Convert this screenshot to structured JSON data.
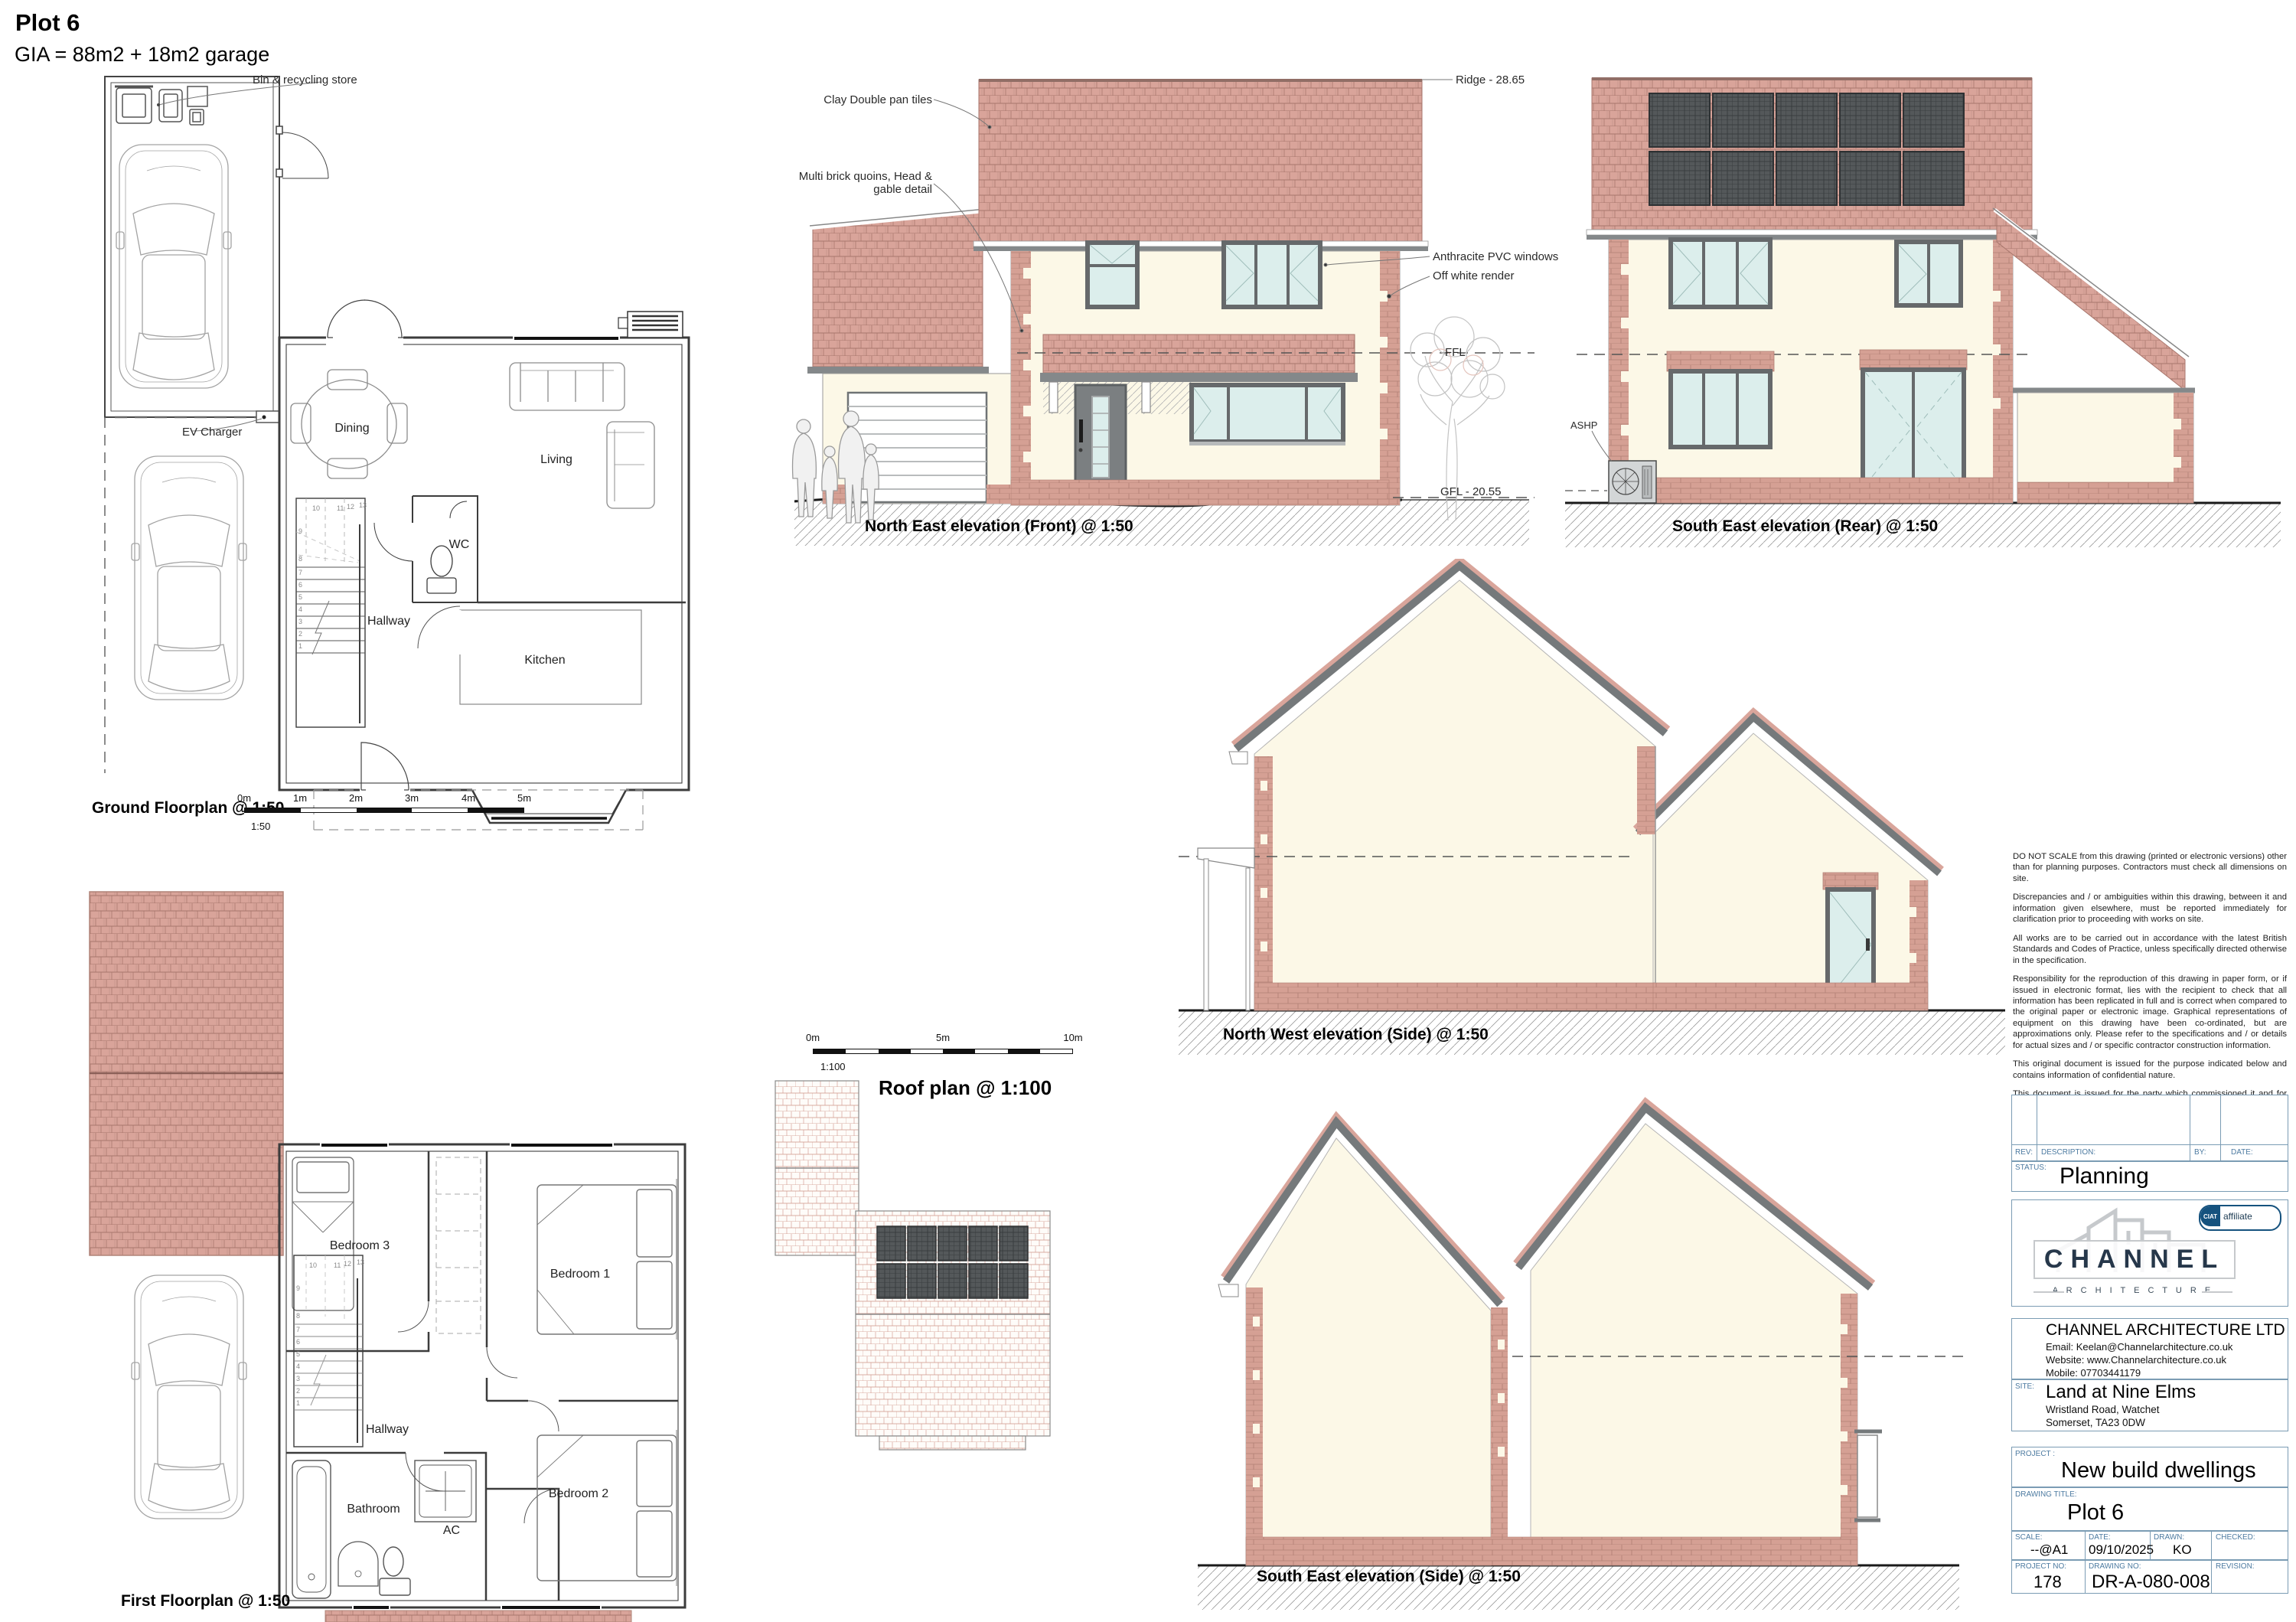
{
  "sheet": {
    "plot_title": "Plot 6",
    "gia": "GIA = 88m2 + 18m2 garage"
  },
  "site_plan": {
    "bin_store_label": "Bin & recycling store",
    "ev_charger_label": "EV Charger"
  },
  "ground_floor": {
    "title": "Ground Floorplan  @ 1:50",
    "rooms": {
      "dining": "Dining",
      "living": "Living",
      "wc": "WC",
      "hallway": "Hallway",
      "kitchen": "Kitchen"
    },
    "scale_bar": {
      "marks": [
        "0m",
        "1m",
        "2m",
        "3m",
        "4m",
        "5m"
      ],
      "ratio": "1:50"
    }
  },
  "first_floor": {
    "title": "First Floorplan  @ 1:50",
    "rooms": {
      "bedroom3": "Bedroom 3",
      "bedroom1": "Bedroom 1",
      "hallway": "Hallway",
      "bathroom": "Bathroom",
      "ac": "AC",
      "bedroom2": "Bedroom 2"
    }
  },
  "roof_plan": {
    "title": "Roof plan @ 1:100",
    "scale_bar": {
      "marks": [
        "0m",
        "5m",
        "10m"
      ],
      "ratio": "1:100"
    }
  },
  "elevations": {
    "front": {
      "title": "North East elevation (Front)  @ 1:50",
      "annotations": {
        "tiles": "Clay Double pan tiles",
        "quoins_line1": "Multi brick quoins, Head &",
        "quoins_line2": "gable detail",
        "ridge": "Ridge - 28.65",
        "windows": "Anthracite PVC windows",
        "render": "Off white render",
        "ffl": "FFL",
        "gfl": "GFL - 20.55"
      }
    },
    "rear": {
      "title": "South East elevation (Rear)  @ 1:50",
      "ashp": "ASHP"
    },
    "side_nw": {
      "title": "North West elevation (Side)  @ 1:50"
    },
    "side_se": {
      "title": "South East elevation (Side)  @ 1:50"
    }
  },
  "stairs": [
    "1",
    "2",
    "3",
    "4",
    "5",
    "6",
    "7",
    "8",
    "9",
    "10",
    "11",
    "12",
    "13"
  ],
  "notes": [
    "DO NOT SCALE from this drawing (printed or electronic versions) other than for planning purposes. Contractors must check all dimensions on site.",
    "Discrepancies and / or ambiguities within this drawing, between it and information given elsewhere, must be reported immediately for clarification prior to proceeding with works on site.",
    "All works are to be carried out in accordance with the latest British Standards and Codes of Practice, unless specifically directed otherwise in the specification.",
    "Responsibility for the reproduction of this drawing in paper form, or if issued in electronic format, lies with the recipient to check that all information has been replicated in full and is correct when compared to the original paper or electronic image. Graphical representations of equipment on this drawing have been co-ordinated, but are approximations only. Please refer to the specifications and / or details for actual sizes and / or specific contractor construction information.",
    "This original document is issued for the purpose indicated below and contains information of confidential nature.",
    "This document is issued for the party which commissioned it and for specific purposes connected with the project detailed below in the project title.",
    "We accept no responsibility for the consequences of this document being relied upon by any other party, or being used for any other purpose, or containing any error or omission which is due to an error or omission in data supplied to us by others."
  ],
  "title_block": {
    "rev_label": "REV:",
    "description_label": "DESCRIPTION:",
    "by_label": "BY:",
    "date_col_label": "DATE:",
    "status_label": "STATUS:",
    "status_value": "Planning",
    "logo": {
      "name": "CHANNEL",
      "sub": "A R C H I T E C T U R E",
      "ciat": "CIAT",
      "affiliate": "affiliate"
    },
    "company": {
      "name": "CHANNEL ARCHITECTURE LTD",
      "email": "Email:  Keelan@Channelarchitecture.co.uk",
      "website": "Website:  www.Channelarchitecture.co.uk",
      "mobile": "Mobile:  07703441179"
    },
    "site": {
      "label": "SITE:",
      "name": "Land at Nine Elms",
      "address1": "Wristland Road, Watchet",
      "address2": "Somerset, TA23 0DW"
    },
    "project": {
      "label": "PROJECT  :",
      "value": "New build dwellings"
    },
    "drawing": {
      "label": "DRAWING  TITLE:",
      "value": "Plot 6"
    },
    "fields": {
      "scale_label": "SCALE:",
      "scale_value": "--@A1",
      "date_label": "DATE:",
      "date_value": "09/10/2025",
      "drawn_label": "DRAWN:",
      "drawn_value": "KO",
      "checked_label": "CHECKED:",
      "checked_value": "",
      "project_no_label": "PROJECT  NO:",
      "project_no_value": "178",
      "drawing_no_label": "DRAWING  NO:",
      "drawing_no_value": "DR-A-080-008",
      "revision_label": "REVISION:",
      "revision_value": ""
    }
  },
  "colors": {
    "roof_tile": "#d9a49a",
    "roof_tile_line": "#a8766c",
    "brick": "#d5a094",
    "render": "#fcf8e7",
    "fascia": "#84888a",
    "window_frame": "#66696b",
    "glass": "#dceeec",
    "solar_panel": "#54585a",
    "table_line_blue": "#7b9cb4",
    "label_blue": "#4d7ba1"
  }
}
